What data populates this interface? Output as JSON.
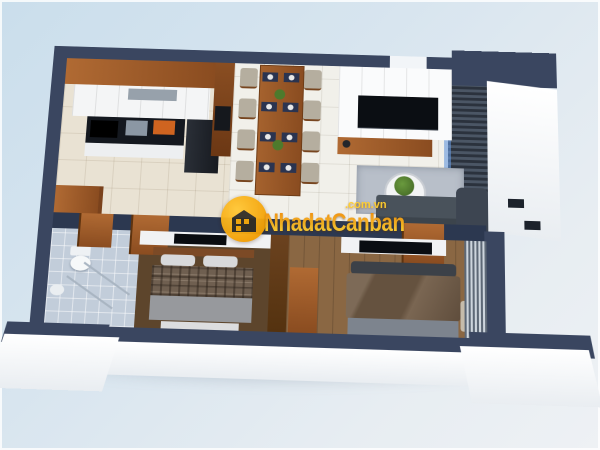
{
  "watermark": {
    "brand": "NhadatCanban",
    "domain": ".com.vn",
    "logo_icon": "house-icon",
    "colors": {
      "circle": "#f5a406",
      "text_top": "#ee8a05",
      "text_bottom": "#ffd83a"
    }
  },
  "scene": {
    "type": "3d-apartment-floor-plan-render",
    "palette": {
      "background": "#d8e5ef",
      "exterior_wall_top": "#3a4660",
      "interior_wall": "#2c3850",
      "wood": "#9a5b2c",
      "kitchen_tile": "#e9e2d3",
      "main_tile": "#f1f0ea",
      "bath_tile": "#c2cdda",
      "bedroom2_floor": "#8a6743",
      "rug": "#b8bfc9",
      "sofa": "#49525b"
    },
    "rooms": [
      {
        "name": "kitchen",
        "furniture": [
          "upper-wood-cabinets",
          "white-cabinets",
          "cooktop",
          "sink",
          "cutting-board",
          "fridge",
          "pantry-column",
          "laundry-cabinet"
        ]
      },
      {
        "name": "dining-room",
        "furniture": [
          "wooden-dining-table",
          "eight-chairs",
          "eight-place-settings",
          "table-plants"
        ]
      },
      {
        "name": "living-room",
        "furniture": [
          "tv-panel-wall",
          "tv",
          "wood-console",
          "rug",
          "round-coffee-table",
          "plant",
          "sofa",
          "curtain"
        ]
      },
      {
        "name": "bathroom",
        "furniture": [
          "toilet",
          "sink",
          "glass-shower"
        ]
      },
      {
        "name": "bedroom-1",
        "furniture": [
          "tv",
          "bed-plaid-blanket",
          "bench",
          "door"
        ]
      },
      {
        "name": "bedroom-2",
        "furniture": [
          "tv",
          "bed-brown-blanket",
          "bench",
          "curtains",
          "wardrobe-panel",
          "door"
        ]
      },
      {
        "name": "balcony",
        "furniture": [
          "louver-deck",
          "glass-door"
        ]
      }
    ]
  }
}
